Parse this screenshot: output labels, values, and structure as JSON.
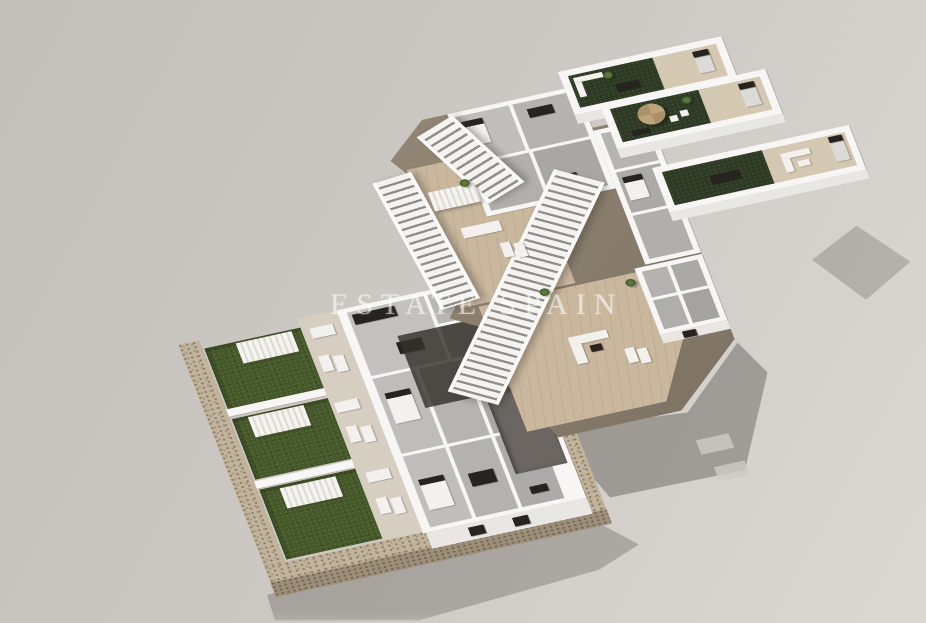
{
  "watermark": {
    "text": "ESTATE SPAIN"
  },
  "colors": {
    "background_start": "#c2bfba",
    "background_end": "#dcd9d4",
    "wall_white": "#f7f6f4",
    "wall_front": "#e9e7e3",
    "floor_gray": "#c0beba",
    "deck_wood": "#c9b79e",
    "terrace_beige": "#d5c8b2",
    "grass_green": "#46592b",
    "turf_dark": "#2e3a25",
    "stone_tan": "#c2b49c",
    "shadow": "#6e6a60",
    "furniture_dark": "#27241f"
  },
  "scene": {
    "type": "3d-floorplan-render",
    "levels": [
      "ground-floor-with-gardens",
      "first-floor-with-staircase",
      "roof-solarium-terraces"
    ]
  }
}
